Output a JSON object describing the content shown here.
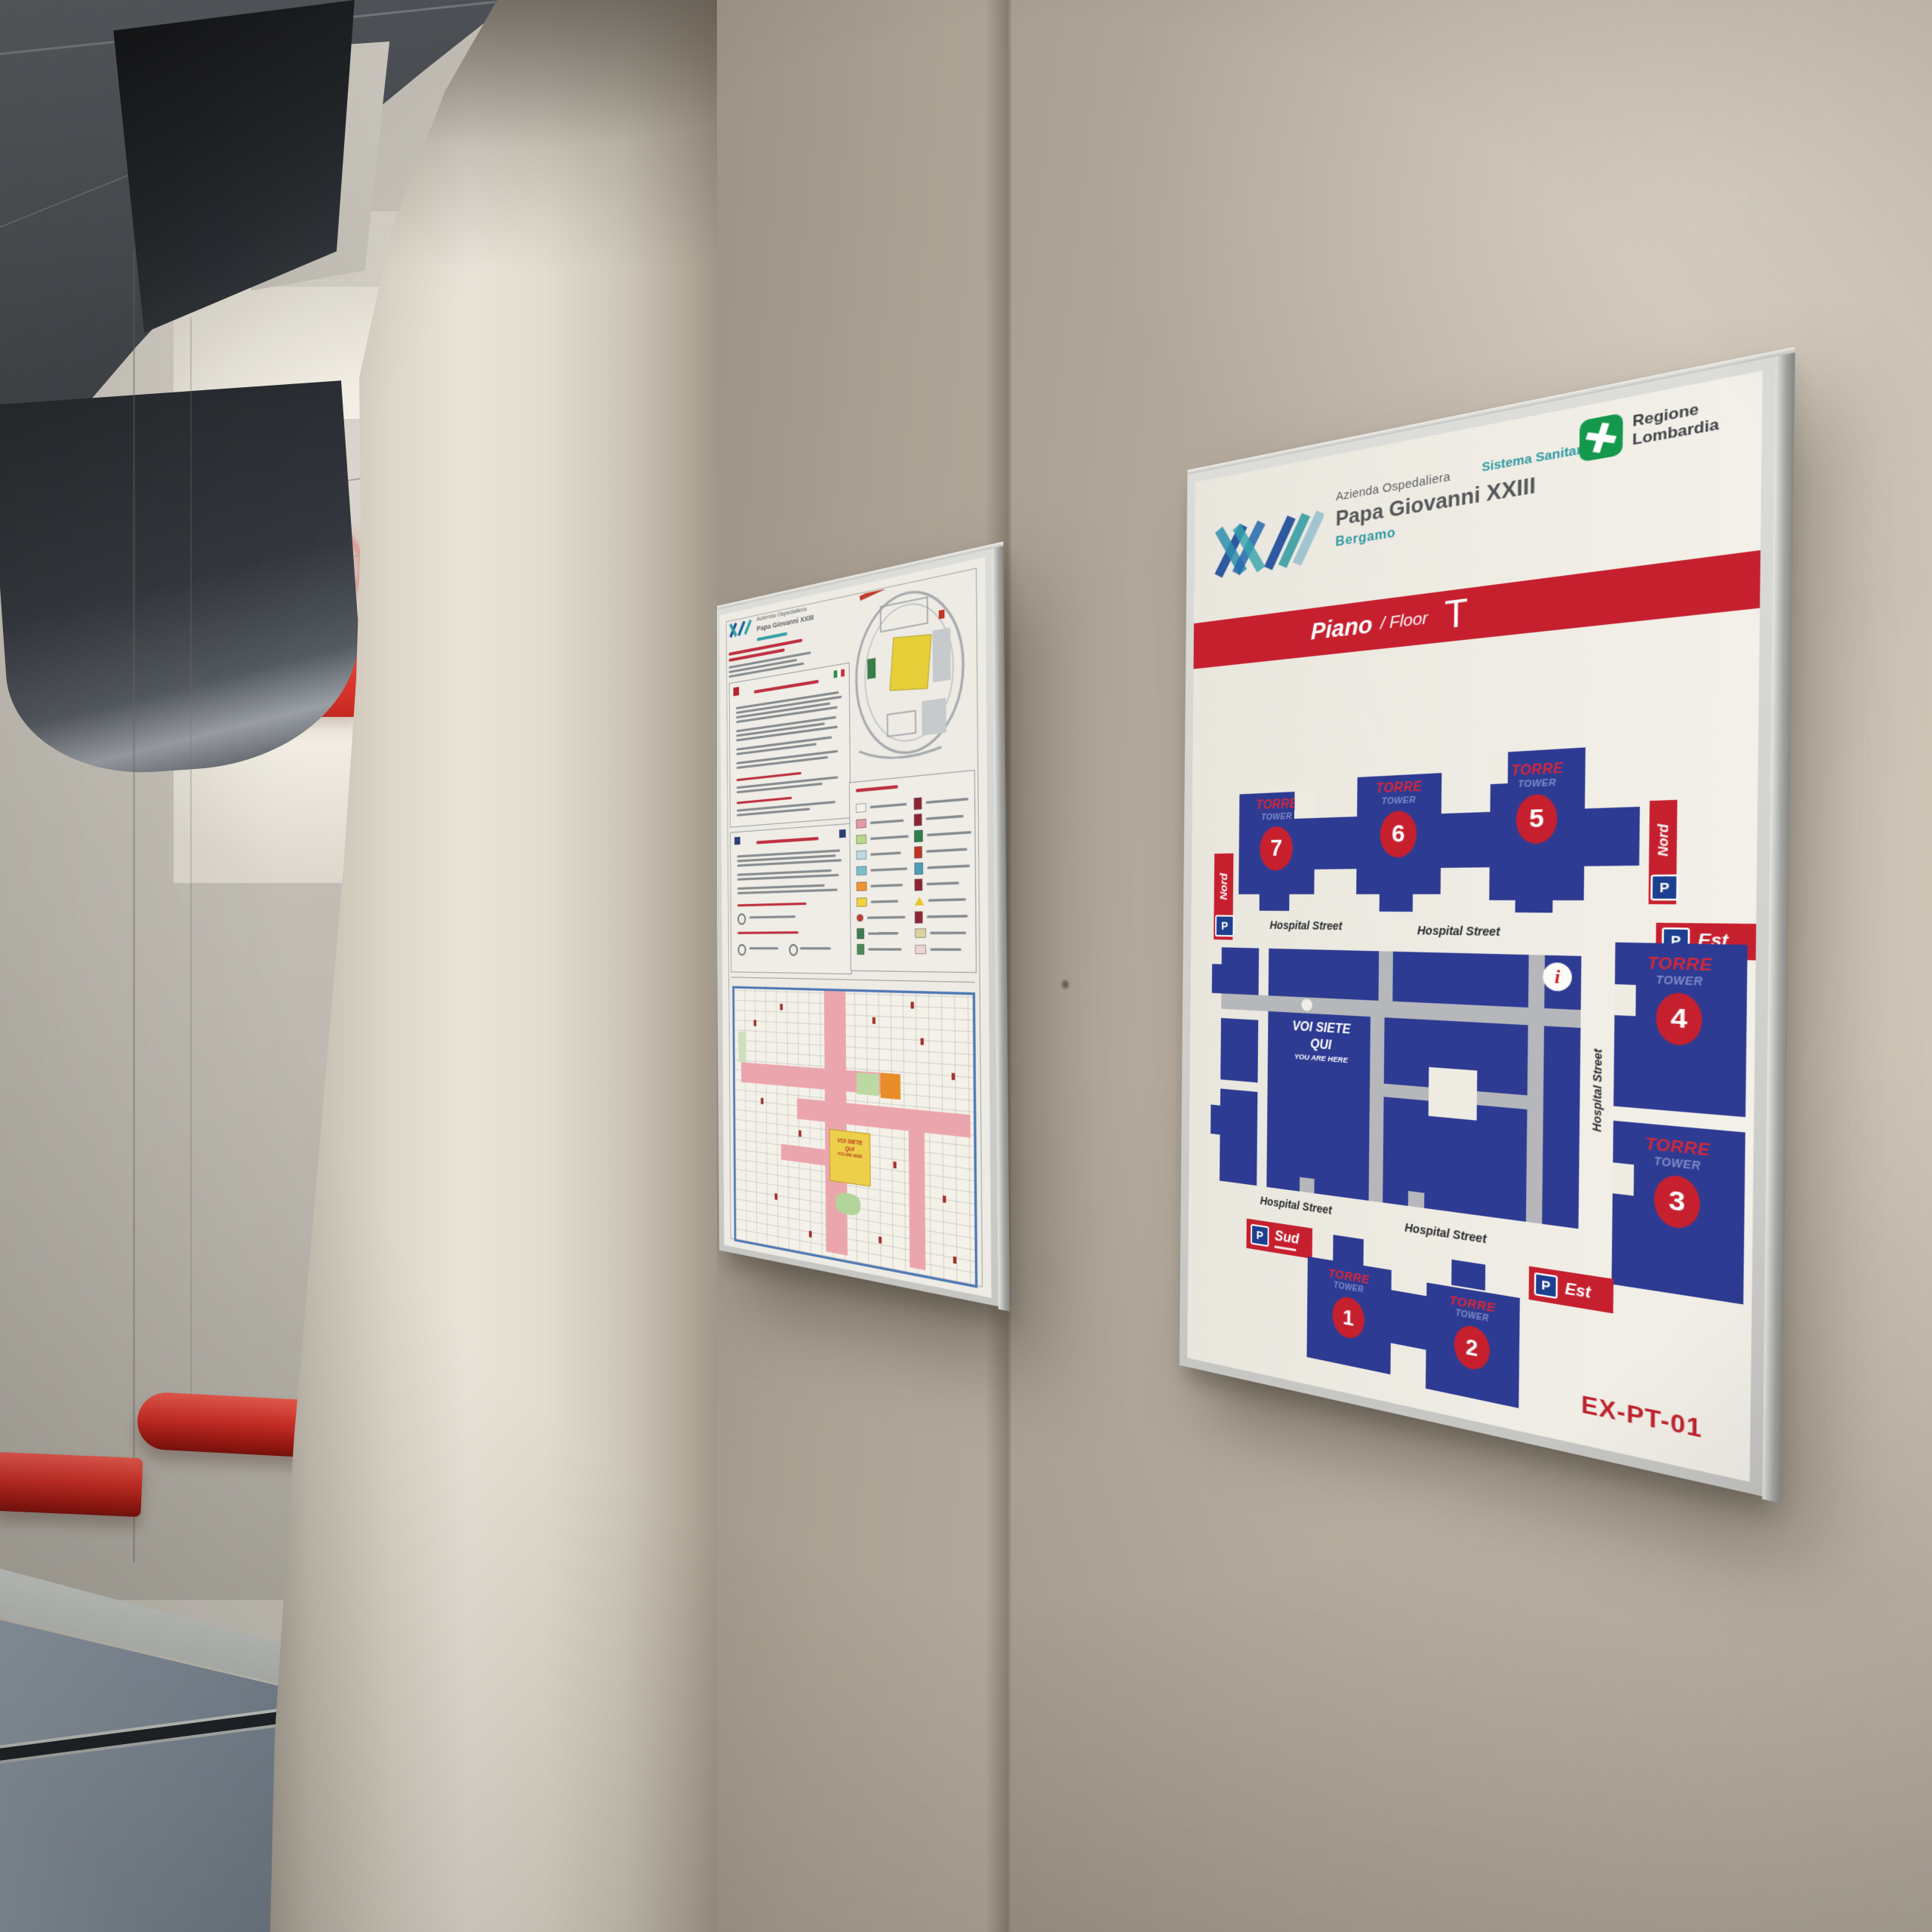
{
  "scene": {
    "colors": {
      "wall_beige": "#b7ad9f",
      "floor_blue_gray": "#8a96a3",
      "handrail_red": "#d02f27",
      "illuminated_sign_red": "#e2453e",
      "accent_red": "#c6202f",
      "map_blue": "#2e3b93",
      "street_gray": "#b5b7ba",
      "regione_green": "#14984b",
      "teal": "#2f9aa2"
    }
  },
  "right_sign": {
    "header": {
      "org_line1": "Azienda Ospedaliera",
      "org_line2": "Papa Giovanni XXIII",
      "org_city": "Bergamo",
      "sistema_sanitario": "Sistema Sanitario",
      "regione_line1": "Regione",
      "regione_line2": "Lombardia"
    },
    "floor_bar": {
      "label_it": "Piano",
      "label_en": "/ Floor",
      "floor_letter": "T"
    },
    "map": {
      "street_label": "Hospital Street",
      "tower_label": "TORRE",
      "tower_sublabel": "TOWER",
      "tower_numbers": [
        "1",
        "2",
        "3",
        "4",
        "5",
        "6",
        "7"
      ],
      "parking_p": "P",
      "parking_nord": "Nord",
      "parking_est": "Est",
      "parking_sud": "Sud",
      "info_symbol": "i",
      "you_are_here": {
        "line1": "VOI SIETE",
        "line2": "QUI",
        "line3": "YOU ARE HERE"
      }
    },
    "footer_code": "EX-PT-01"
  },
  "left_sign": {
    "header_line1": "Azienda Ospedaliera",
    "header_line2": "Papa Giovanni XXIII",
    "you_are_here_box": {
      "line1": "VOI SIETE",
      "line2": "QUI",
      "line3": "YOU ARE HERE"
    },
    "legend_left_swatches": [
      "#f2f0ea",
      "#e59aa6",
      "#b8d98e",
      "#bdd9e4",
      "#7fbecb",
      "#ef9430",
      "#f2d43c",
      "#c23b2f",
      "#3e7d4f",
      "#4d8a5a"
    ],
    "legend_right_swatches": [
      "#8e2433",
      "#8e2433",
      "#2f7d4a",
      "#c03327",
      "#4a9db4",
      "#8e2433",
      "#e8c32e",
      "#8e2433",
      "#ddd3a0",
      "#eed5d2"
    ]
  }
}
